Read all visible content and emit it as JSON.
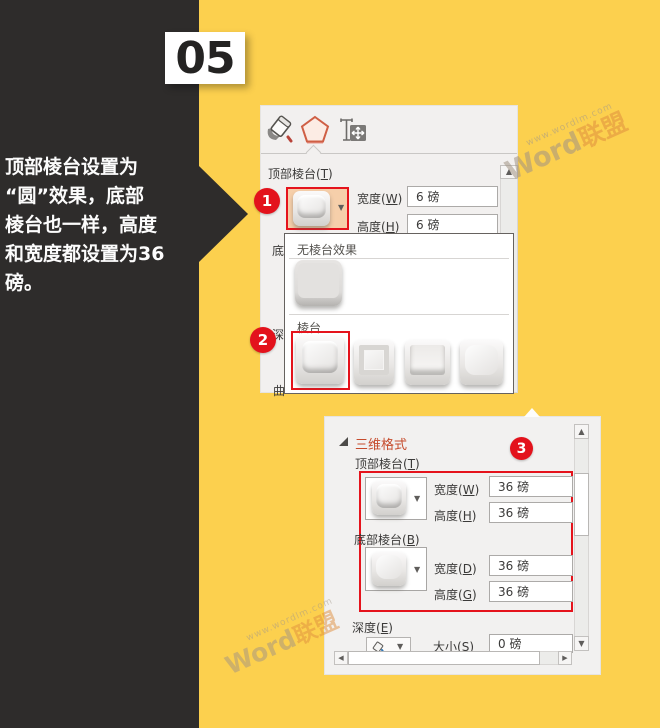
{
  "badge": {
    "number": "05"
  },
  "caption": {
    "lines": [
      "顶部棱台设置为",
      "“圆”效果，底部",
      "棱台也一样，高度",
      "和宽度都设置为36",
      "磅。"
    ]
  },
  "annotations": {
    "one": "1",
    "two": "2",
    "three": "3"
  },
  "glyphs": {
    "down": "▼",
    "up": "▲",
    "left": "◀",
    "right": "▶"
  },
  "watermark": {
    "url": "www.wordlm.com",
    "brand_primary": "Word",
    "brand_secondary": "联盟"
  },
  "format_pane": {
    "top_bevel_label": "顶部棱台(T)",
    "width_label": "宽度(W)",
    "width_value": "6 磅",
    "height_label": "高度(H)",
    "height_value": "6 磅",
    "clipped_labels": {
      "bottom": "底",
      "depth": "深",
      "curve": "曲"
    }
  },
  "bevel_dropdown": {
    "none_header": "无棱台效果",
    "group_header": "棱台"
  },
  "format_pane2": {
    "section_title": "三维格式",
    "top_bevel_label": "顶部棱台(T)",
    "top_width_label": "宽度(W)",
    "top_width_value": "36 磅",
    "top_height_label": "高度(H)",
    "top_height_value": "36 磅",
    "bottom_bevel_label": "底部棱台(B)",
    "bottom_width_label": "宽度(D)",
    "bottom_width_value": "36 磅",
    "bottom_height_label": "高度(G)",
    "bottom_height_value": "36 磅",
    "depth_label": "深度(E)",
    "size_label": "大小(S)",
    "size_value": "0 磅"
  }
}
